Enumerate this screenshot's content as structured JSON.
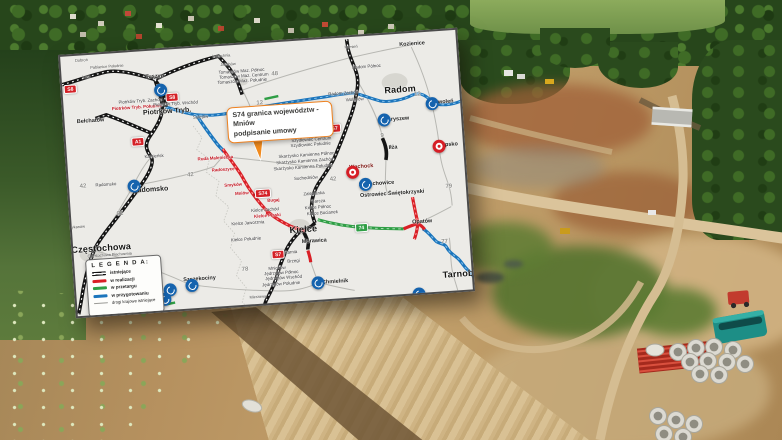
{
  "image": {
    "kind": "aerial construction photo with road-map inset",
    "colors": {
      "map_blue": "#1b75bc",
      "map_red": "#d91f26",
      "map_green": "#2f9e45",
      "map_black": "#151515",
      "callout_orange": "#ef8220",
      "van_teal": "#1d8e86"
    }
  },
  "map": {
    "callout": {
      "line1": "S74 granica województw - Mniów",
      "line2": "podpisanie umowy"
    },
    "legend": {
      "title": "L E G E N D A:",
      "items": [
        {
          "label": "istniejące",
          "color": "#111111",
          "swatch": "double"
        },
        {
          "label": "w realizacji",
          "color": "#d91f26",
          "swatch": "thick"
        },
        {
          "label": "w przetargu",
          "color": "#2f9e45",
          "swatch": "thick"
        },
        {
          "label": "w przygotowaniu",
          "color": "#1b75bc",
          "swatch": "thick"
        },
        {
          "label": "drogi krajowe istniejące",
          "color": "#9a9a96",
          "swatch": "thin"
        }
      ]
    },
    "badges": [
      {
        "text": "S8",
        "x": 8,
        "y": 33,
        "type": "red"
      },
      {
        "text": "S8",
        "x": 109,
        "y": 48,
        "type": "red"
      },
      {
        "text": "A1",
        "x": 72,
        "y": 90,
        "type": "red"
      },
      {
        "text": "S7",
        "x": 269,
        "y": 90,
        "type": "red"
      },
      {
        "text": "S7",
        "x": 204,
        "y": 212,
        "type": "red"
      },
      {
        "text": "S74",
        "x": 193,
        "y": 150,
        "type": "red"
      },
      {
        "text": "74",
        "x": 289,
        "y": 191,
        "type": "green"
      }
    ],
    "markers": [
      {
        "type": "blue",
        "x": 98,
        "y": 40,
        "name": "Piotrków Trybunalski"
      },
      {
        "type": "blue",
        "x": 65,
        "y": 134,
        "name": "Radomsko"
      },
      {
        "type": "blue",
        "x": 319,
        "y": 85,
        "name": "Skaryszew"
      },
      {
        "type": "blue",
        "x": 368,
        "y": 72,
        "name": "Zwoleń"
      },
      {
        "type": "blue",
        "x": 296,
        "y": 148,
        "name": "Starachowice"
      },
      {
        "type": "blue",
        "x": 242,
        "y": 243,
        "name": "Chmielnik"
      },
      {
        "type": "blue",
        "x": 116,
        "y": 237,
        "name": "Szczekociny"
      },
      {
        "type": "blue",
        "x": 94,
        "y": 240,
        "name": ""
      },
      {
        "type": "blue",
        "x": 88,
        "y": 249,
        "name": ""
      },
      {
        "type": "blue",
        "x": 342,
        "y": 261,
        "name": ""
      },
      {
        "type": "red",
        "x": 284,
        "y": 135,
        "name": "Wąchock"
      },
      {
        "type": "red",
        "x": 372,
        "y": 115,
        "name": "Lipsko"
      }
    ],
    "labels": [
      {
        "text": "Radom",
        "x": 337,
        "y": 56,
        "cls": "city"
      },
      {
        "text": "Kielce",
        "x": 231,
        "y": 189,
        "cls": "city"
      },
      {
        "text": "Częstochowa",
        "x": 28,
        "y": 194,
        "cls": "city"
      },
      {
        "text": "Tarnobrzeg",
        "x": 392,
        "y": 244,
        "cls": "city"
      },
      {
        "text": "Piotrków Tryb.",
        "x": 103,
        "y": 62,
        "cls": "city2"
      },
      {
        "text": "Radomsko",
        "x": 81,
        "y": 139,
        "cls": "city2"
      },
      {
        "text": "Tuszyn",
        "x": 93,
        "y": 27,
        "cls": "town"
      },
      {
        "text": "Bełchatów",
        "x": 26,
        "y": 67,
        "cls": "town"
      },
      {
        "text": "Iłża",
        "x": 326,
        "y": 114,
        "cls": "town"
      },
      {
        "text": "Morawica",
        "x": 241,
        "y": 202,
        "cls": "town"
      },
      {
        "text": "Opatów",
        "x": 350,
        "y": 190,
        "cls": "town"
      },
      {
        "text": "Ostrowiec Świętokrzyski",
        "x": 322,
        "y": 160,
        "cls": "town"
      },
      {
        "text": "Starachowice",
        "x": 307,
        "y": 149,
        "cls": "town"
      },
      {
        "text": "Wąchock",
        "x": 293,
        "y": 131,
        "cls": "townred"
      },
      {
        "text": "Kozienice",
        "x": 352,
        "y": 12,
        "cls": "town"
      },
      {
        "text": "Zwoleń",
        "x": 380,
        "y": 72,
        "cls": "town"
      },
      {
        "text": "Skaryszew",
        "x": 330,
        "y": 86,
        "cls": "town"
      },
      {
        "text": "Lipsko",
        "x": 382,
        "y": 115,
        "cls": "town"
      },
      {
        "text": "Chmielnik",
        "x": 259,
        "y": 244,
        "cls": "town"
      },
      {
        "text": "Szczekociny",
        "x": 124,
        "y": 232,
        "cls": "town"
      },
      {
        "text": "Sulejów",
        "x": 136,
        "y": 70,
        "cls": "small"
      },
      {
        "text": "Kamieńsk",
        "x": 87,
        "y": 106,
        "cls": "small"
      },
      {
        "text": "Mierzawa",
        "x": 181,
        "y": 253,
        "cls": "tiny"
      },
      {
        "text": "Kamień",
        "x": 291,
        "y": 10,
        "cls": "tiny"
      },
      {
        "text": "Lubochnia",
        "x": 161,
        "y": 10,
        "cls": "tiny"
      },
      {
        "text": "Jakubów",
        "x": 167,
        "y": 19,
        "cls": "tiny"
      },
      {
        "text": "Łask",
        "x": 25,
        "y": 22,
        "cls": "tiny"
      },
      {
        "text": "Dobroń",
        "x": 21,
        "y": 5,
        "cls": "tiny"
      },
      {
        "text": "Pabianice Południe",
        "x": 46,
        "y": 13,
        "cls": "tiny"
      },
      {
        "text": "Mykanów",
        "x": 5,
        "y": 171,
        "cls": "tiny"
      },
      {
        "text": "Częstochowa Błachownia",
        "x": 36,
        "y": 201,
        "cls": "tiny"
      },
      {
        "text": "Piotrków Tryb. Zachód",
        "x": 77,
        "y": 50,
        "cls": "small"
      },
      {
        "text": "Piotrków Tryb. Południe",
        "x": 73,
        "y": 56,
        "cls": "red"
      },
      {
        "text": "Piotrków Tryb. Wschód",
        "x": 112,
        "y": 55,
        "cls": "small"
      },
      {
        "text": "Tomaszów Maz. Północ",
        "x": 180,
        "y": 27,
        "cls": "small"
      },
      {
        "text": "Tomaszów Maz. Centrum",
        "x": 182,
        "y": 32,
        "cls": "small"
      },
      {
        "text": "Tomaszów Maz. Południe",
        "x": 180,
        "y": 37,
        "cls": "small"
      },
      {
        "text": "Radom Północ",
        "x": 305,
        "y": 31,
        "cls": "small"
      },
      {
        "text": "Radom Zachód",
        "x": 280,
        "y": 56,
        "cls": "small"
      },
      {
        "text": "Wolanów",
        "x": 291,
        "y": 63,
        "cls": "small"
      },
      {
        "text": "Szydłowiec Północ",
        "x": 246,
        "y": 95,
        "cls": "small"
      },
      {
        "text": "Szydłowiec Centrum",
        "x": 245,
        "y": 100,
        "cls": "small"
      },
      {
        "text": "Szydłowiec Południe",
        "x": 244,
        "y": 105,
        "cls": "small"
      },
      {
        "text": "Skarżysko Kamienna Północ",
        "x": 239,
        "y": 115,
        "cls": "small"
      },
      {
        "text": "Skarżysko Kamienna Zachód",
        "x": 237,
        "y": 121,
        "cls": "small"
      },
      {
        "text": "Skarżysko Kamienna Południe",
        "x": 235,
        "y": 127,
        "cls": "small"
      },
      {
        "text": "Suchedniów",
        "x": 237,
        "y": 138,
        "cls": "small"
      },
      {
        "text": "Zalezianka",
        "x": 244,
        "y": 154,
        "cls": "small"
      },
      {
        "text": "Barcza",
        "x": 248,
        "y": 162,
        "cls": "small"
      },
      {
        "text": "Kielce Północ",
        "x": 247,
        "y": 168,
        "cls": "small"
      },
      {
        "text": "Kielce Bocianek",
        "x": 251,
        "y": 174,
        "cls": "small"
      },
      {
        "text": "Kielce Zachód",
        "x": 194,
        "y": 167,
        "cls": "small"
      },
      {
        "text": "Kielce Jaworznia",
        "x": 176,
        "y": 179,
        "cls": "small"
      },
      {
        "text": "Kielce Południe",
        "x": 173,
        "y": 195,
        "cls": "small"
      },
      {
        "text": "Tokarnia",
        "x": 215,
        "y": 211,
        "cls": "small"
      },
      {
        "text": "Brzegi",
        "x": 219,
        "y": 220,
        "cls": "small"
      },
      {
        "text": "Mnichów",
        "x": 202,
        "y": 226,
        "cls": "small"
      },
      {
        "text": "Jędrzejów Północ",
        "x": 206,
        "y": 231,
        "cls": "small"
      },
      {
        "text": "Jędrzejów Wschód",
        "x": 208,
        "y": 236,
        "cls": "small"
      },
      {
        "text": "Jędrzejów Południe",
        "x": 205,
        "y": 242,
        "cls": "small"
      },
      {
        "text": "Ruda Maleniecka",
        "x": 148,
        "y": 112,
        "cls": "red"
      },
      {
        "text": "Radoszyce",
        "x": 155,
        "y": 124,
        "cls": "red"
      },
      {
        "text": "Smyków",
        "x": 164,
        "y": 140,
        "cls": "red"
      },
      {
        "text": "Mniów",
        "x": 172,
        "y": 149,
        "cls": "red"
      },
      {
        "text": "Bugaj",
        "x": 203,
        "y": 158,
        "cls": "red"
      },
      {
        "text": "Kielce Piaski",
        "x": 196,
        "y": 173,
        "cls": "red"
      },
      {
        "text": "48",
        "x": 213,
        "y": 32,
        "cls": "num"
      },
      {
        "text": "12",
        "x": 196,
        "y": 60,
        "cls": "num"
      },
      {
        "text": "12",
        "x": 354,
        "y": 62,
        "cls": "num"
      },
      {
        "text": "42",
        "x": 122,
        "y": 127,
        "cls": "num"
      },
      {
        "text": "42",
        "x": 264,
        "y": 141,
        "cls": "num"
      },
      {
        "text": "42",
        "x": 14,
        "y": 131,
        "cls": "num"
      },
      {
        "text": "Radomsko",
        "x": 37,
        "y": 131,
        "cls": "small"
      },
      {
        "text": "91",
        "x": 49,
        "y": 161,
        "cls": "num"
      },
      {
        "text": "9",
        "x": 316,
        "y": 101,
        "cls": "num"
      },
      {
        "text": "78",
        "x": 170,
        "y": 225,
        "cls": "num"
      },
      {
        "text": "79",
        "x": 379,
        "y": 156,
        "cls": "num"
      },
      {
        "text": "77",
        "x": 371,
        "y": 211,
        "cls": "num"
      }
    ]
  }
}
